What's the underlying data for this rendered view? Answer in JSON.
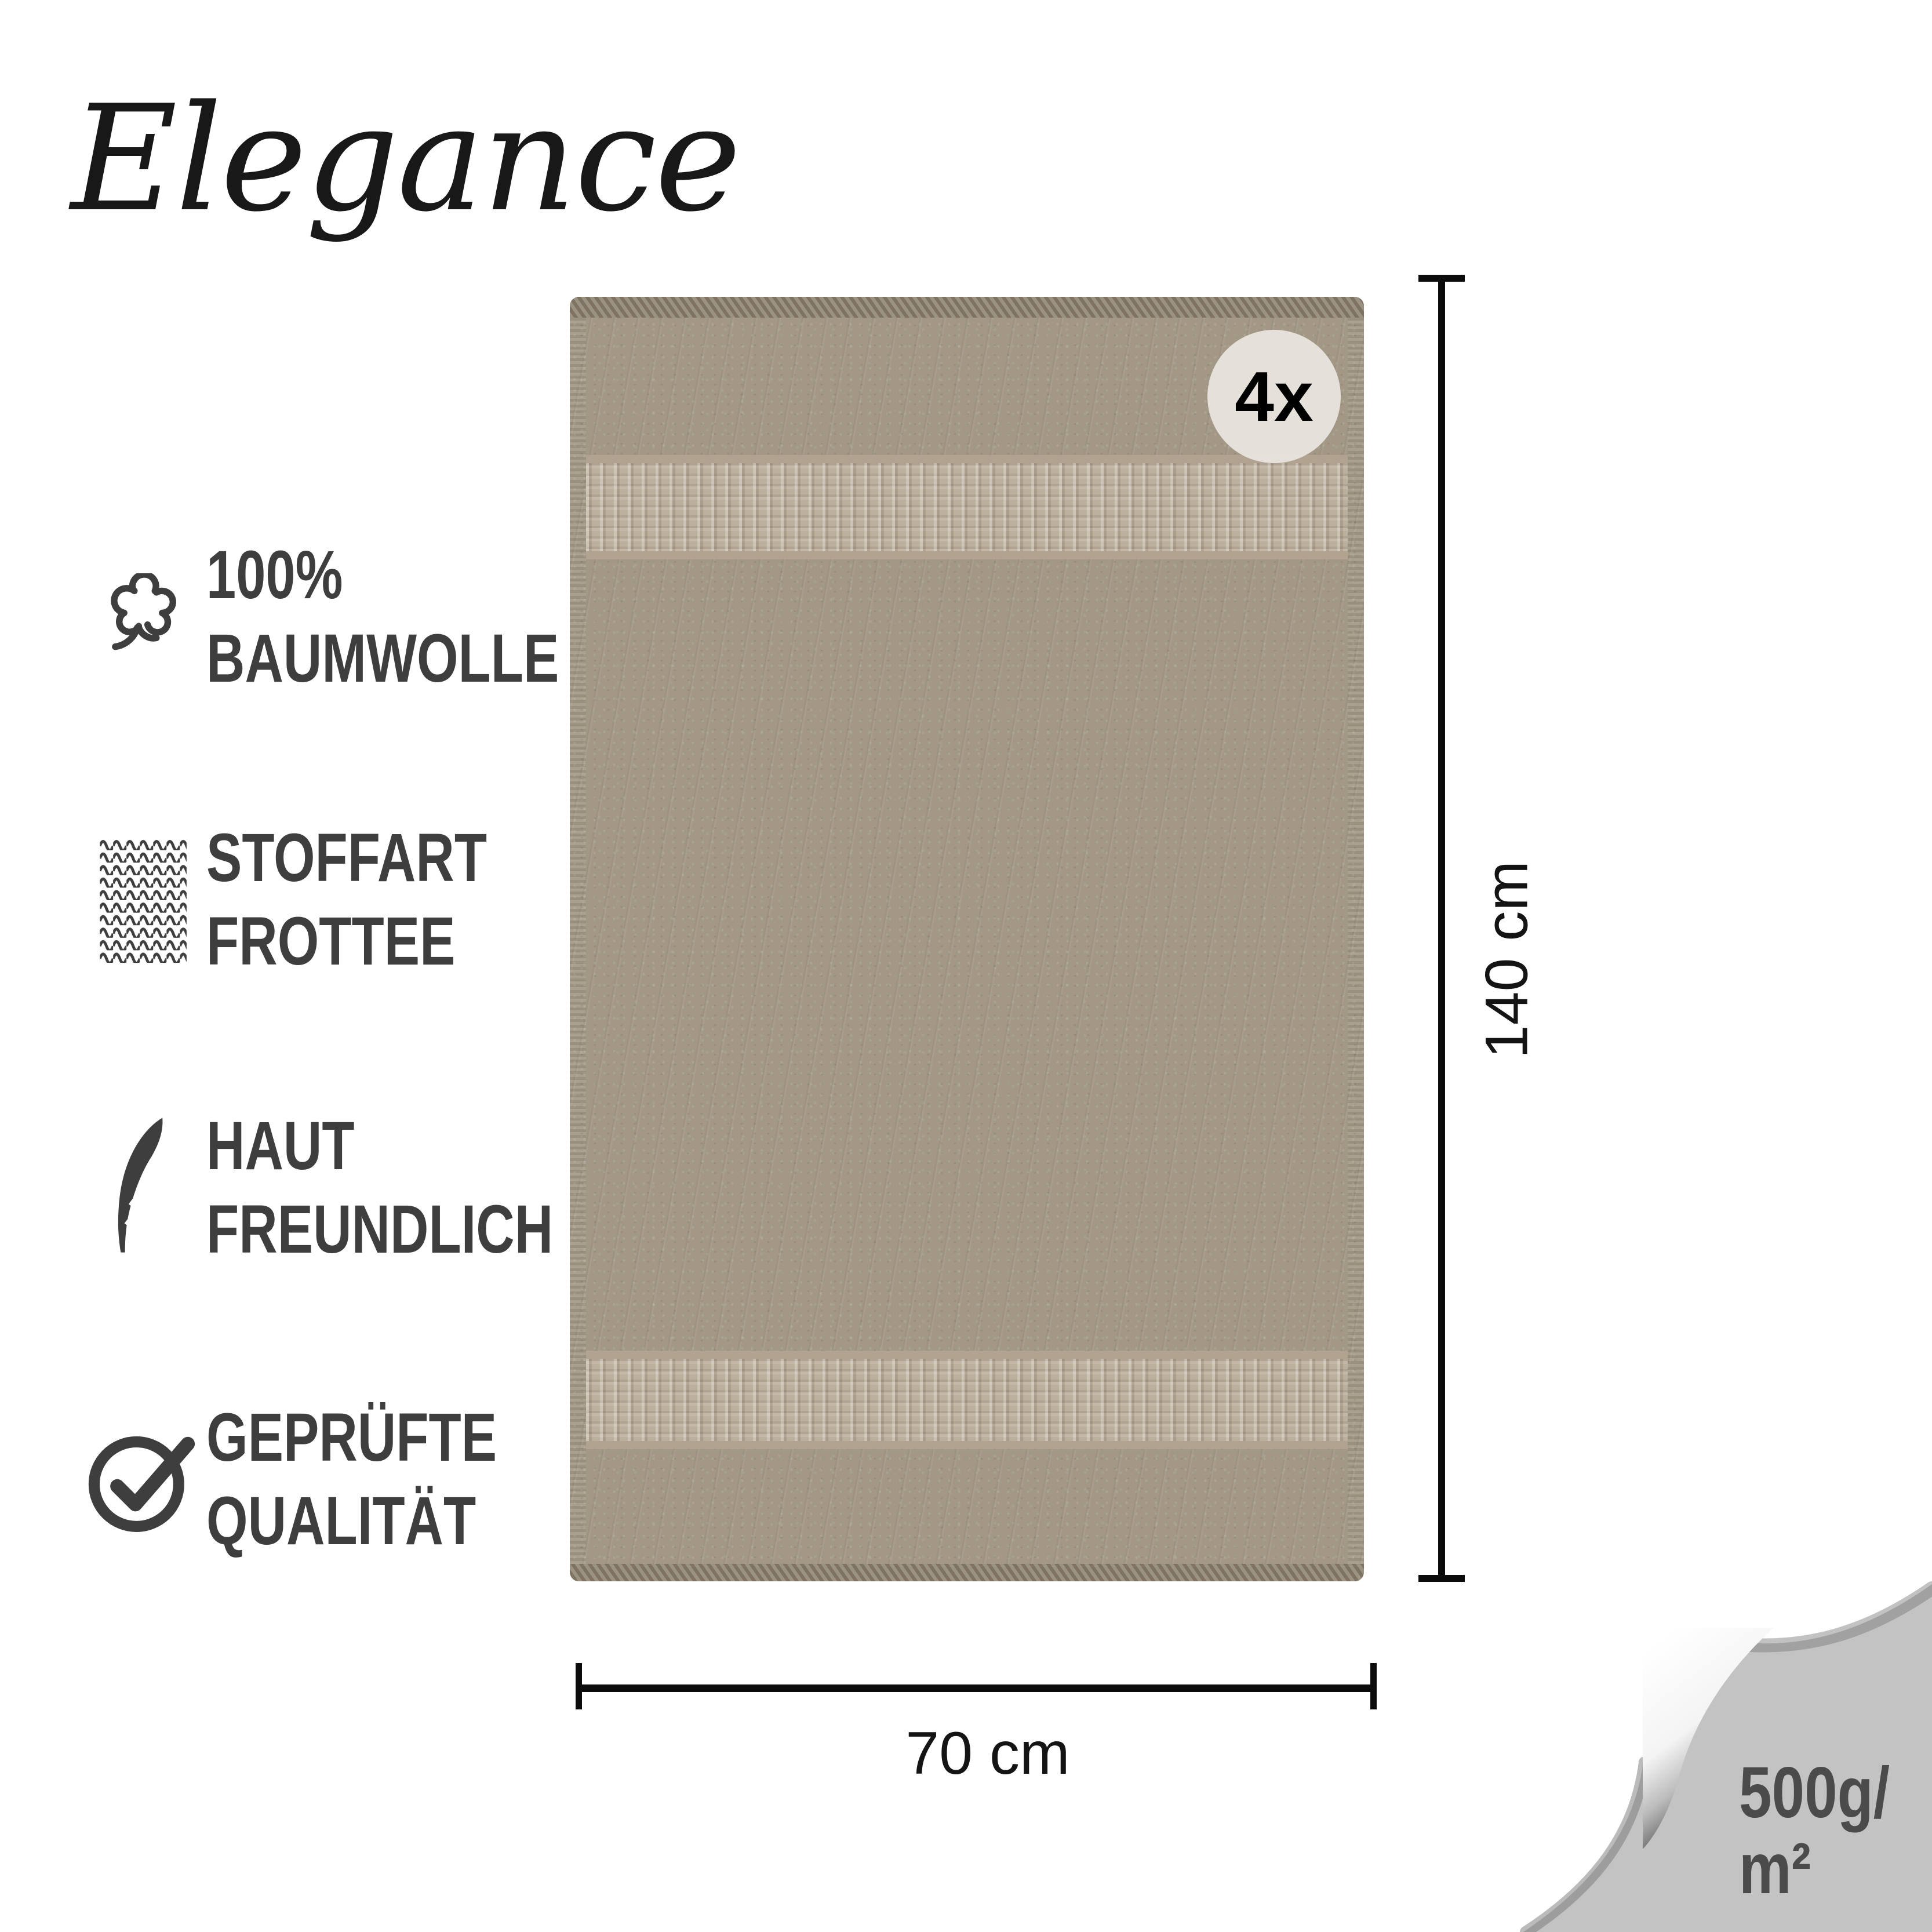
{
  "brand": {
    "name": "Elegance"
  },
  "features": [
    {
      "icon": "cotton-icon",
      "line1": "100%",
      "line2": "BAUMWOLLE"
    },
    {
      "icon": "knit-texture-icon",
      "line1": "STOFFART",
      "line2": "FROTTEE"
    },
    {
      "icon": "feather-icon",
      "line1": "HAUT",
      "line2": "FREUNDLICH"
    },
    {
      "icon": "check-circle-icon",
      "line1": "GEPRÜFTE",
      "line2": "QUALITÄT"
    }
  ],
  "towel": {
    "badge": "4x",
    "base_color": "#a39886",
    "band_color": "#b7aa97",
    "selvedge_color": "#8f8371"
  },
  "dimensions": {
    "height": "140 cm",
    "width": "70 cm"
  },
  "weight": {
    "line1": "500g/",
    "line2": "m²"
  },
  "colors": {
    "feature_text": "#3e3e3e",
    "dimension_line": "#0c0c0c",
    "badge_bg": "#e9e6df",
    "corner_bg": "#c3c3c3",
    "corner_text": "#4b4b4b",
    "logo": "#181818"
  }
}
